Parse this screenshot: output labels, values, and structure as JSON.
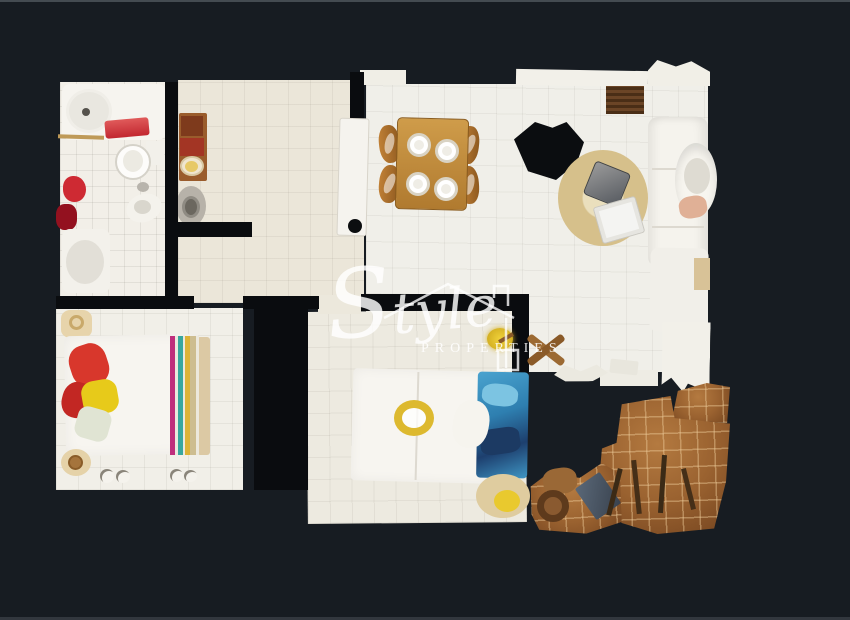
{
  "scene": {
    "description": "Top-down 3D dollhouse scan floor plan of an apartment on dark background",
    "background_color": "#171c22",
    "wall_color": "#0a0c0f"
  },
  "watermark": {
    "script_initial": "S",
    "script_rest": "tyle",
    "subtext": "PROPERTIES",
    "icon": "house-outline-icon",
    "text_color": "rgba(255,255,255,0.82)"
  },
  "rooms": [
    {
      "id": "bathroom",
      "floor_color": "#f2efe8",
      "items": [
        "bathtub",
        "towel-bar",
        "red-towel",
        "toilet",
        "bidet",
        "red-bath-mat",
        "dark-red-towel",
        "shower-tray"
      ]
    },
    {
      "id": "hallway",
      "floor_color": "#ebe6d9",
      "items": [
        "console-cabinet",
        "decor-bowl",
        "round-pan",
        "open-door"
      ]
    },
    {
      "id": "living-dining",
      "floor_color": "#f0efe9",
      "items": [
        "kitchen-counter",
        "kitchen-grill",
        "dining-table",
        "four-plates",
        "four-chairs",
        "scan-hole",
        "round-rug",
        "coffee-table",
        "white-tray",
        "corner-sofa",
        "armchair",
        "pink-cushion",
        "curtain-fragment",
        "wood-cross-fragment"
      ]
    },
    {
      "id": "bedroom-1",
      "floor_color": "#f1efe8",
      "items": [
        "double-bed",
        "headboard",
        "rainbow-striped-blanket",
        "red-pillow",
        "dark-red-pillow",
        "yellow-pillow",
        "sage-pillow",
        "bedside-table",
        "round-stool",
        "slippers"
      ]
    },
    {
      "id": "bedroom-2",
      "floor_color": "#edeae0",
      "items": [
        "double-bed",
        "blue-bedding",
        "white-pillow",
        "yellow-wreath",
        "round-rug",
        "yellow-lamp"
      ]
    },
    {
      "id": "terrace",
      "floor_color": "#9a6230",
      "items": [
        "terracotta-tiles",
        "railing-fragment",
        "wood-posts",
        "wooden-chair-fragment",
        "white-scan-fragments"
      ]
    }
  ],
  "palette": {
    "floor_white": "#f0ede5",
    "floor_beige": "#ebe6d9",
    "terrace_tile": "#9a6230",
    "rug_tan": "#d6c08b",
    "table_wood": "#b07a2f",
    "bed_white": "#f7f5f0",
    "pillow_red": "#d8372c",
    "pillow_yellow": "#e7ca1a",
    "stripe_magenta": "#bf2e7c",
    "stripe_teal": "#38a79d",
    "bedding_blue": "#3f96c4",
    "towel_red": "#cb3038"
  }
}
